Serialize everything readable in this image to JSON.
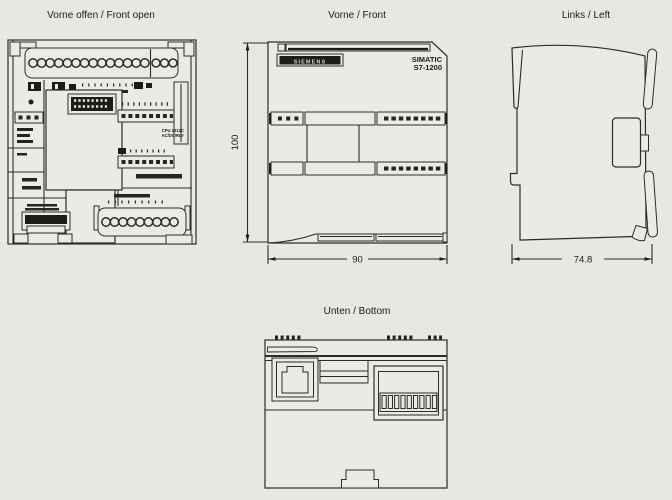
{
  "page": {
    "background": "#e8e7e2",
    "line_color": "#2d2c29"
  },
  "views": {
    "front_open": {
      "title": "Vorne offen / Front open",
      "cpu_label_line1": "CPU 1212C",
      "cpu_label_line2": "AC/DC/RLY"
    },
    "front": {
      "title": "Vorne / Front",
      "brand_logo": "SIEMENS",
      "product_line1": "SIMATIC",
      "product_line2": "S7-1200",
      "height_dim": "100",
      "width_dim": "90"
    },
    "left": {
      "title": "Links / Left",
      "depth_dim": "74.8"
    },
    "bottom": {
      "title": "Unten / Bottom"
    }
  }
}
